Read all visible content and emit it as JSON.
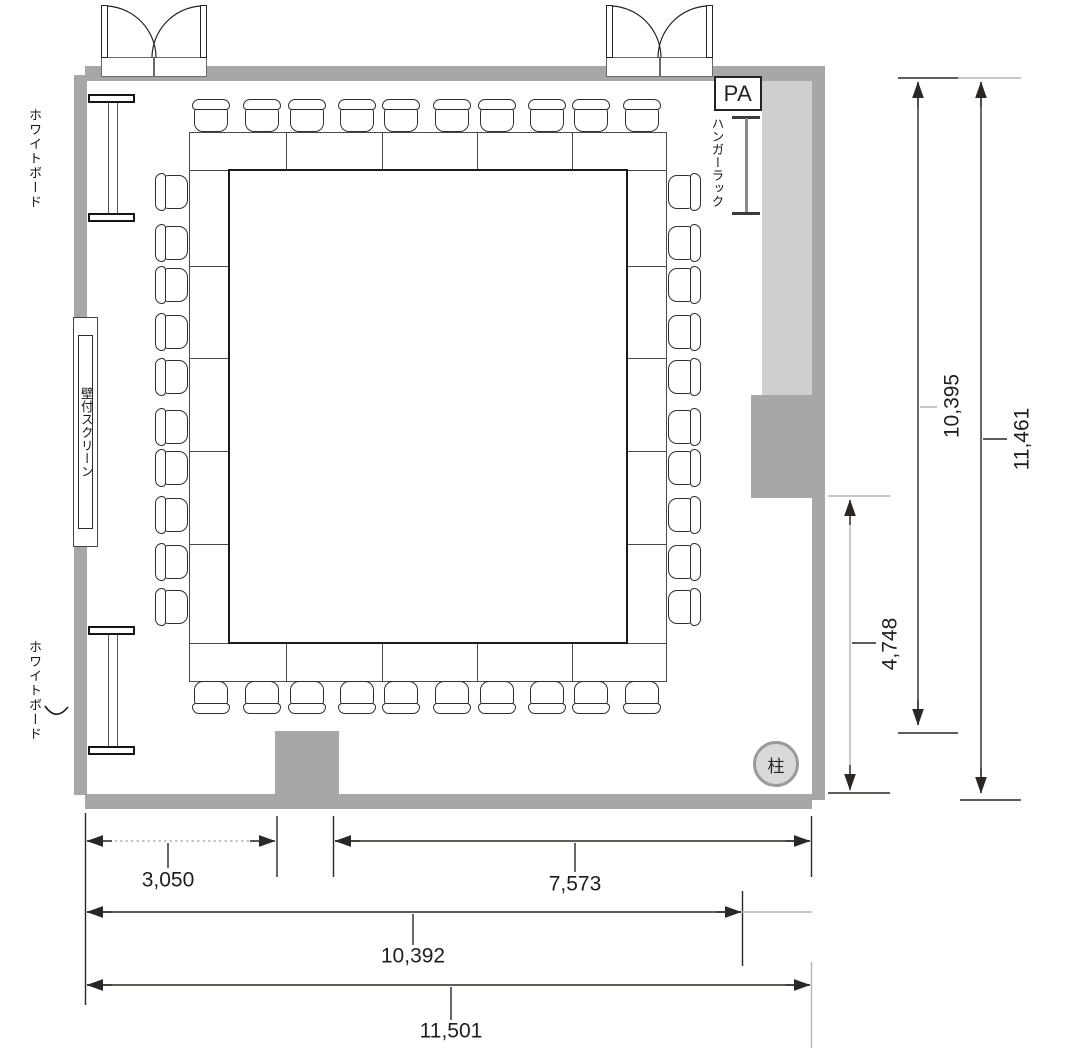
{
  "plan": {
    "whiteboard_top_label": "ホワイトボード",
    "whiteboard_bottom_label": "ホワイトボード",
    "screen_label": "壁付スクリーン",
    "hanger_label": "ハンガーラック",
    "pa_label": "PA",
    "pillar_label": "柱"
  },
  "dims": {
    "bottom_left": "3,050",
    "bottom_right": "7,573",
    "bottom_inner_total": "10,392",
    "bottom_outer_total": "11,501",
    "right_inner_height": "10,395",
    "right_outer_height": "11,461",
    "right_lower_height": "4,748"
  },
  "furniture": {
    "seat_count": 40,
    "table_segments_per_side": 5
  }
}
